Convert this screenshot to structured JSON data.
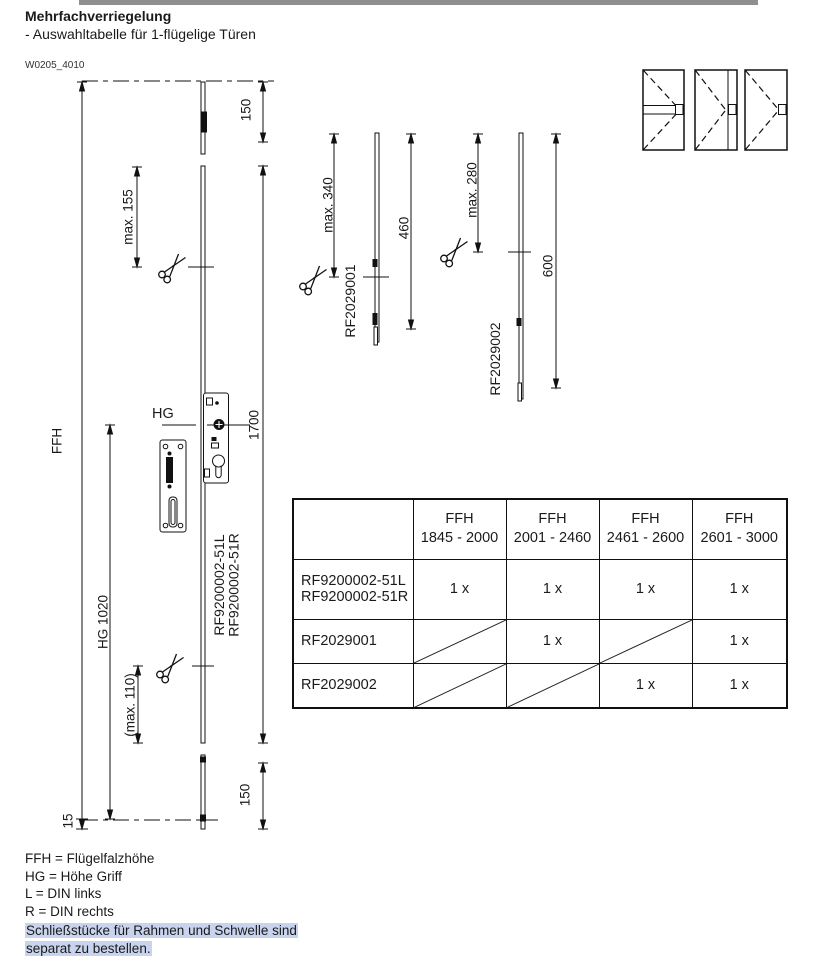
{
  "header": {
    "title": "Mehrfachverriegelung",
    "subtitle": "- Auswahltabelle für 1-flügelige Türen",
    "drawing_id": "W0205_4010"
  },
  "colors": {
    "top_bar": "#8f8f8f",
    "note_highlight": "#c8d3ee",
    "line_color": "#111111"
  },
  "diagram": {
    "labels": {
      "ffh": "FFH",
      "top_offset": "150",
      "max_155": "max. 155",
      "hg": "HG",
      "length_1700": "1700",
      "part_left": "RF9200002-51L",
      "part_right": "RF9200002-51R",
      "hg_1020": "HG 1020",
      "max_110": "(max. 110)",
      "offset_15": "15",
      "bottom_offset": "150",
      "max_340": "max. 340",
      "ext_part_1": "RF2029001",
      "length_460": "460",
      "max_280": "max. 280",
      "ext_part_2": "RF2029002",
      "length_600": "600"
    }
  },
  "table": {
    "columns": [
      {
        "title": "FFH",
        "range": "1845 - 2000"
      },
      {
        "title": "FFH",
        "range": "2001 - 2460"
      },
      {
        "title": "FFH",
        "range": "2461 - 2600"
      },
      {
        "title": "FFH",
        "range": "2601 - 3000"
      }
    ],
    "rows": [
      {
        "label1": "RF9200002-51L",
        "label2": "RF9200002-51R",
        "cells": [
          "1 x",
          "1 x",
          "1 x",
          "1 x"
        ]
      },
      {
        "label1": "RF2029001",
        "label2": "",
        "cells": [
          "",
          "1 x",
          "",
          "1 x"
        ]
      },
      {
        "label1": "RF2029002",
        "label2": "",
        "cells": [
          "",
          "",
          "1 x",
          "1 x"
        ]
      }
    ]
  },
  "legend": {
    "line1": "FFH = Flügelfalzhöhe",
    "line2": "HG = Höhe Griff",
    "line3": "L = DIN links",
    "line4": "R = DIN rechts",
    "note_line1": "Schließstücke für Rahmen und Schwelle sind",
    "note_line2": "separat zu bestellen."
  }
}
